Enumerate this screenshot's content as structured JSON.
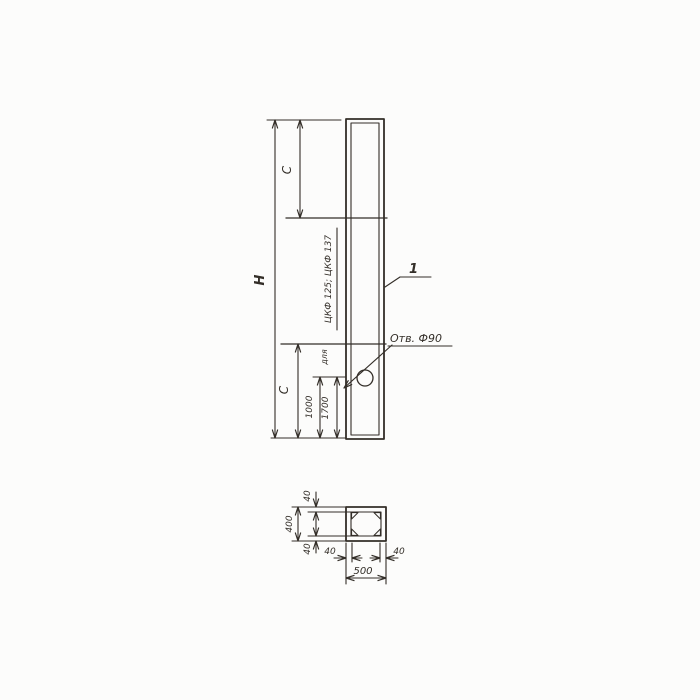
{
  "colors": {
    "ink": "#332e28",
    "paper": "#fcfcfb"
  },
  "elevation": {
    "height_label": "H",
    "top_segment_label": "C",
    "bottom_segment_label": "C",
    "hole_offset_primary": "1000",
    "hole_offset_secondary": "1700",
    "note_prefix": "для",
    "note_series": "ЦКФ 125; ЦКФ 137",
    "hole_label": "Отв. Ф90",
    "part_mark": "1"
  },
  "section": {
    "overall_width": "500",
    "overall_height": "400",
    "wall_top": "40",
    "wall_bottom": "40",
    "wall_left": "40",
    "wall_right": "40"
  }
}
